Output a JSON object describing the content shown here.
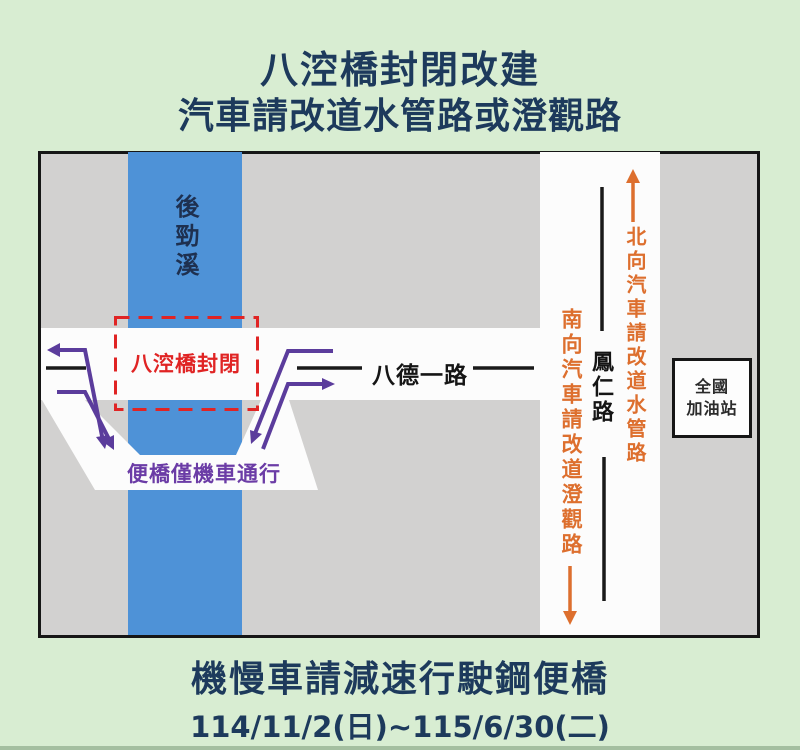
{
  "page": {
    "title_line1": "八涳橋封閉改建",
    "title_line2": "汽車請改道水管路或澄觀路",
    "footer_line1": "機慢車請減速行駛鋼便橋",
    "footer_dates": "114/11/2(日)~115/6/30(二)"
  },
  "map": {
    "river_label": "後勁溪",
    "closed_bridge_label": "八涳橋封閉",
    "temp_bridge_label": "便橋僅機車通行",
    "horizontal_road_label": "八德一路",
    "vertical_road_label": "鳳仁路",
    "southbound_notice": "南向汽車請改道澄觀路",
    "northbound_notice": "北向汽車請改道水管路",
    "gas_station_line1": "全國",
    "gas_station_line2": "加油站"
  },
  "colors": {
    "background_green": "#d8edd2",
    "title_navy": "#1d3a5c",
    "map_gray": "#d2d1d0",
    "river_blue": "#4e92d7",
    "road_white": "#fcfcfc",
    "closure_red": "#e02424",
    "detour_purple": "#5b3c9c",
    "notice_orange": "#dd6f2e"
  }
}
